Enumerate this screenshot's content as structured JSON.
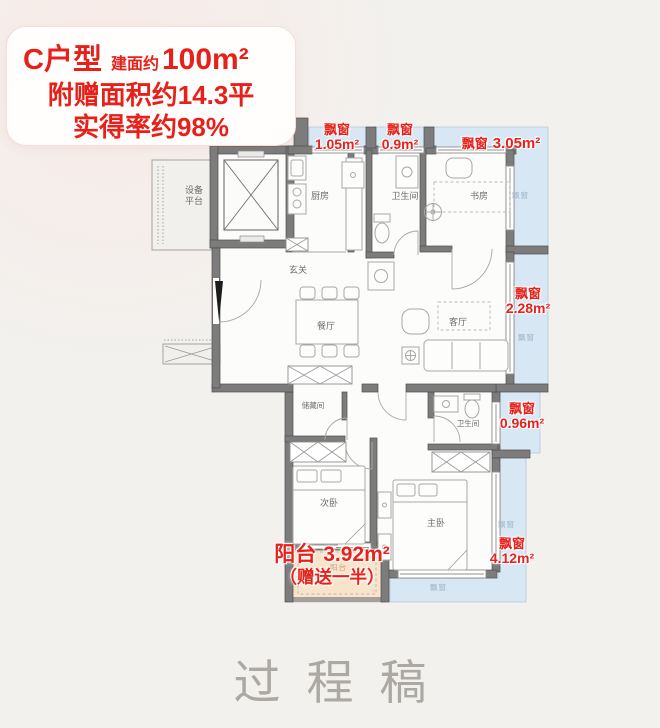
{
  "info_card": {
    "unit": "C户型",
    "area_label": "建面约",
    "area_value": "100m²",
    "bonus_line": "附赠面积约14.3平",
    "ratio_line": "实得率约98%"
  },
  "annotations": {
    "bay1": {
      "name": "飘窗",
      "value": "1.05m²"
    },
    "bay2": {
      "name": "飘窗",
      "value": "0.9m²"
    },
    "bay3": {
      "name": "飘窗",
      "value": "3.05m²"
    },
    "bay4": {
      "name": "飘窗",
      "value": "2.28m²"
    },
    "bay5": {
      "name": "飘窗",
      "value": "0.96m²"
    },
    "bay6": {
      "name": "飘窗",
      "value": "4.12m²"
    },
    "balcony": {
      "name": "阳台",
      "value": "3.92m²",
      "note": "（赠送一半）"
    }
  },
  "rooms": {
    "equipment_platform": "设备平台",
    "kitchen": "厨房",
    "bath1": "卫生间",
    "study": "书房",
    "foyer": "玄关",
    "dining": "餐厅",
    "living": "客厅",
    "storage": "储藏间",
    "bedroom2": "次卧",
    "bath2": "卫生间",
    "master": "主卧"
  },
  "zone_texts": {
    "bay_window": "飘窗",
    "balcony": "阳台"
  },
  "watermark": "过程稿",
  "colors": {
    "accent_red": "#e7221b",
    "bay_blue": "#d7e7f4",
    "balcony_peach": "#f9e3ca",
    "wall_gray": "#7c7c7c"
  }
}
